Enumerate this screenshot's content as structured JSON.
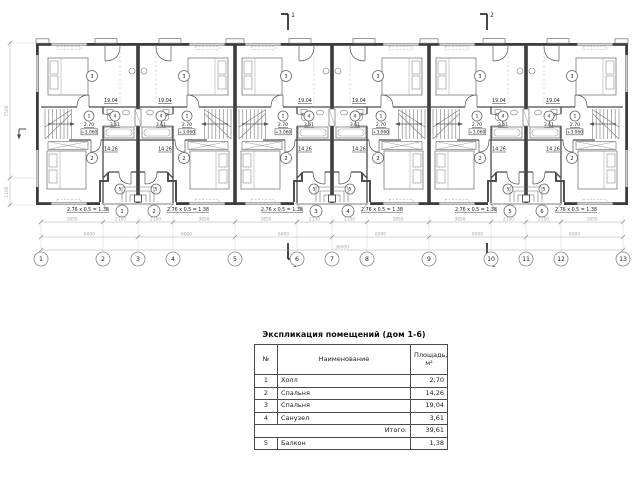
{
  "drawing": {
    "axes": [
      "1",
      "2",
      "3",
      "4",
      "5",
      "6",
      "7",
      "8",
      "9",
      "10",
      "11",
      "12",
      "13"
    ],
    "dim_segments": [
      "3850",
      "2150",
      "2150",
      "3850",
      "3850",
      "2150",
      "2150",
      "3850",
      "3850",
      "2150",
      "2150",
      "3850"
    ],
    "dim_modules": [
      "6000",
      "6000",
      "6000",
      "6000",
      "6000",
      "6000"
    ],
    "dim_total": "36000",
    "dim_left": [
      "7500",
      "1100"
    ],
    "section_marks": [
      "1",
      "2"
    ],
    "unit_numbers": [
      "1",
      "2",
      "3",
      "4",
      "5",
      "6"
    ],
    "rooms": {
      "bedroom_large": {
        "num": "3",
        "area": "19.04"
      },
      "hall": {
        "num": "1",
        "area": "2.70",
        "level": "+3.060"
      },
      "bathroom": {
        "num": "4",
        "area": "3.61"
      },
      "bedroom_small": {
        "num": "2",
        "area": "14.26"
      },
      "balcony": {
        "num": "5",
        "calc": "2.76 x 0.5 = 1.38"
      }
    }
  },
  "table": {
    "title": "Экспликация помещений (дом 1-6)",
    "headers": {
      "num": "№",
      "name": "Наименование",
      "area_line1": "Площадь,",
      "area_line2": "м²"
    },
    "rows": [
      {
        "num": "1",
        "name": "Холл",
        "area": "2,70"
      },
      {
        "num": "2",
        "name": "Спальня",
        "area": "14,26"
      },
      {
        "num": "3",
        "name": "Спальня",
        "area": "19,04"
      },
      {
        "num": "4",
        "name": "Санузел",
        "area": "3,61"
      }
    ],
    "total": {
      "label": "Итого:",
      "value": "39,61"
    },
    "extra_rows": [
      {
        "num": "5",
        "name": "Балкон",
        "area": "1,38"
      }
    ]
  },
  "colors": {
    "wall": "#3c3c3c",
    "partition": "#4a4a4a",
    "thin": "#6e6e6e",
    "furniture": "#7a7a7a",
    "dim": "#a8a8a8",
    "text": "#222222",
    "bg": "#ffffff"
  }
}
